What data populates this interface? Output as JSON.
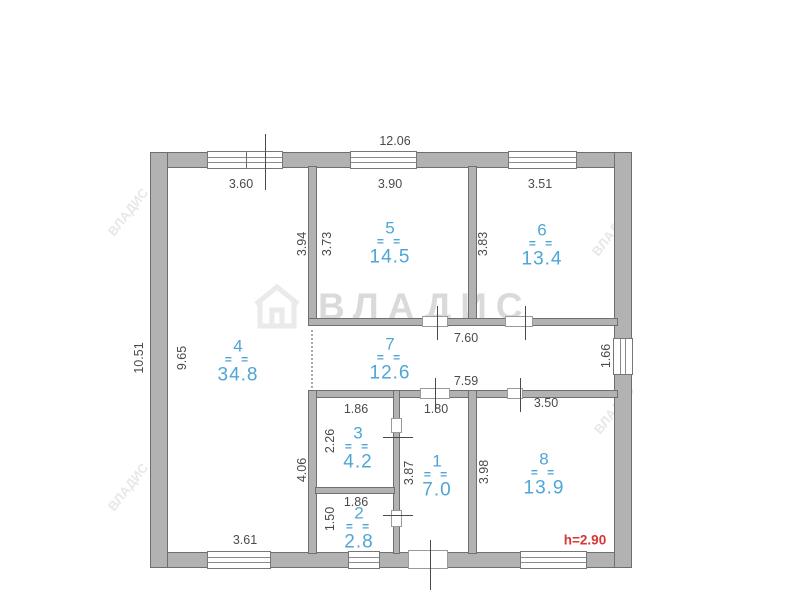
{
  "watermark": {
    "brand": "ВЛАДИС",
    "corner_text": "ВЛАДИС",
    "corners": [
      {
        "x": 128,
        "y": 212
      },
      {
        "x": 128,
        "y": 487
      },
      {
        "x": 612,
        "y": 232
      },
      {
        "x": 614,
        "y": 410
      }
    ]
  },
  "height_note": {
    "text": "h=2.90",
    "x": 585,
    "y": 540
  },
  "plan": {
    "walls": [
      {
        "x": 150,
        "y": 152,
        "w": 482,
        "h": 16
      },
      {
        "x": 150,
        "y": 552,
        "w": 482,
        "h": 16
      },
      {
        "x": 150,
        "y": 152,
        "w": 18,
        "h": 416
      },
      {
        "x": 614,
        "y": 152,
        "w": 18,
        "h": 416
      },
      {
        "x": 308,
        "y": 166,
        "w": 9,
        "h": 160
      },
      {
        "x": 468,
        "y": 166,
        "w": 9,
        "h": 160
      },
      {
        "x": 308,
        "y": 318,
        "w": 310,
        "h": 8
      },
      {
        "x": 308,
        "y": 390,
        "w": 310,
        "h": 8
      },
      {
        "x": 308,
        "y": 390,
        "w": 9,
        "h": 164
      },
      {
        "x": 393,
        "y": 390,
        "w": 7,
        "h": 164
      },
      {
        "x": 315,
        "y": 487,
        "w": 80,
        "h": 7
      },
      {
        "x": 468,
        "y": 390,
        "w": 9,
        "h": 164
      }
    ],
    "windows": [
      {
        "x": 207,
        "y": 151,
        "w": 76,
        "h": 18,
        "o": "h"
      },
      {
        "x": 350,
        "y": 151,
        "w": 67,
        "h": 18,
        "o": "h"
      },
      {
        "x": 508,
        "y": 151,
        "w": 69,
        "h": 18,
        "o": "h"
      },
      {
        "x": 207,
        "y": 551,
        "w": 64,
        "h": 18,
        "o": "h"
      },
      {
        "x": 348,
        "y": 551,
        "w": 32,
        "h": 18,
        "o": "h"
      },
      {
        "x": 520,
        "y": 551,
        "w": 67,
        "h": 18,
        "o": "h"
      },
      {
        "x": 613,
        "y": 338,
        "w": 20,
        "h": 37,
        "o": "v"
      }
    ],
    "doors": [
      {
        "x": 422,
        "y": 316,
        "w": 26,
        "h": 11
      },
      {
        "x": 505,
        "y": 316,
        "w": 28,
        "h": 11
      },
      {
        "x": 420,
        "y": 388,
        "w": 30,
        "h": 11
      },
      {
        "x": 507,
        "y": 388,
        "w": 16,
        "h": 11
      },
      {
        "x": 391,
        "y": 418,
        "w": 11,
        "h": 15
      },
      {
        "x": 391,
        "y": 510,
        "w": 11,
        "h": 17
      },
      {
        "x": 408,
        "y": 550,
        "w": 40,
        "h": 19
      }
    ],
    "ticks": [
      {
        "x": 265,
        "y": 134,
        "w": 1,
        "h": 56
      },
      {
        "x": 437,
        "y": 306,
        "w": 1,
        "h": 34
      },
      {
        "x": 525,
        "y": 306,
        "w": 1,
        "h": 34
      },
      {
        "x": 435,
        "y": 378,
        "w": 1,
        "h": 34
      },
      {
        "x": 520,
        "y": 378,
        "w": 1,
        "h": 34
      },
      {
        "x": 383,
        "y": 437,
        "w": 30,
        "h": 1
      },
      {
        "x": 383,
        "y": 515,
        "w": 30,
        "h": 1
      },
      {
        "x": 430,
        "y": 540,
        "w": 1,
        "h": 50
      }
    ],
    "mullions": [
      {
        "x": 246,
        "y": 152,
        "w": 1,
        "h": 16
      }
    ],
    "dotted": [
      {
        "x": 311,
        "y": 330,
        "h": 58
      }
    ],
    "dim_labels": [
      {
        "text": "12.06",
        "x": 395,
        "y": 141,
        "rot": false
      },
      {
        "text": "3.60",
        "x": 241,
        "y": 184,
        "rot": false
      },
      {
        "text": "3.90",
        "x": 390,
        "y": 184,
        "rot": false
      },
      {
        "text": "3.51",
        "x": 540,
        "y": 184,
        "rot": false
      },
      {
        "text": "10.51",
        "x": 139,
        "y": 358,
        "rot": true
      },
      {
        "text": "9.65",
        "x": 182,
        "y": 358,
        "rot": true
      },
      {
        "text": "3.94",
        "x": 302,
        "y": 244,
        "rot": true
      },
      {
        "text": "3.73",
        "x": 327,
        "y": 244,
        "rot": true
      },
      {
        "text": "3.83",
        "x": 483,
        "y": 244,
        "rot": true
      },
      {
        "text": "7.60",
        "x": 466,
        "y": 338,
        "rot": false
      },
      {
        "text": "7.59",
        "x": 466,
        "y": 381,
        "rot": false
      },
      {
        "text": "1.66",
        "x": 606,
        "y": 356,
        "rot": true
      },
      {
        "text": "1.86",
        "x": 356,
        "y": 409,
        "rot": false
      },
      {
        "text": "1.80",
        "x": 436,
        "y": 409,
        "rot": false
      },
      {
        "text": "3.50",
        "x": 546,
        "y": 403,
        "rot": false
      },
      {
        "text": "2.26",
        "x": 330,
        "y": 441,
        "rot": true
      },
      {
        "text": "3.87",
        "x": 409,
        "y": 473,
        "rot": true
      },
      {
        "text": "3.98",
        "x": 484,
        "y": 472,
        "rot": true
      },
      {
        "text": "4.06",
        "x": 302,
        "y": 470,
        "rot": true
      },
      {
        "text": "1.50",
        "x": 330,
        "y": 519,
        "rot": true
      },
      {
        "text": "1.86",
        "x": 356,
        "y": 502,
        "rot": false
      },
      {
        "text": "3.61",
        "x": 245,
        "y": 540,
        "rot": false
      }
    ],
    "room_divider_glyph": "= =",
    "rooms": [
      {
        "number": "4",
        "area": "34.8",
        "cx": 238,
        "cy": 361
      },
      {
        "number": "5",
        "area": "14.5",
        "cx": 390,
        "cy": 243
      },
      {
        "number": "6",
        "area": "13.4",
        "cx": 542,
        "cy": 245
      },
      {
        "number": "7",
        "area": "12.6",
        "cx": 390,
        "cy": 359
      },
      {
        "number": "3",
        "area": "4.2",
        "cx": 358,
        "cy": 448
      },
      {
        "number": "1",
        "area": "7.0",
        "cx": 437,
        "cy": 476
      },
      {
        "number": "2",
        "area": "2.8",
        "cx": 359,
        "cy": 528
      },
      {
        "number": "8",
        "area": "13.9",
        "cx": 544,
        "cy": 474
      }
    ]
  }
}
